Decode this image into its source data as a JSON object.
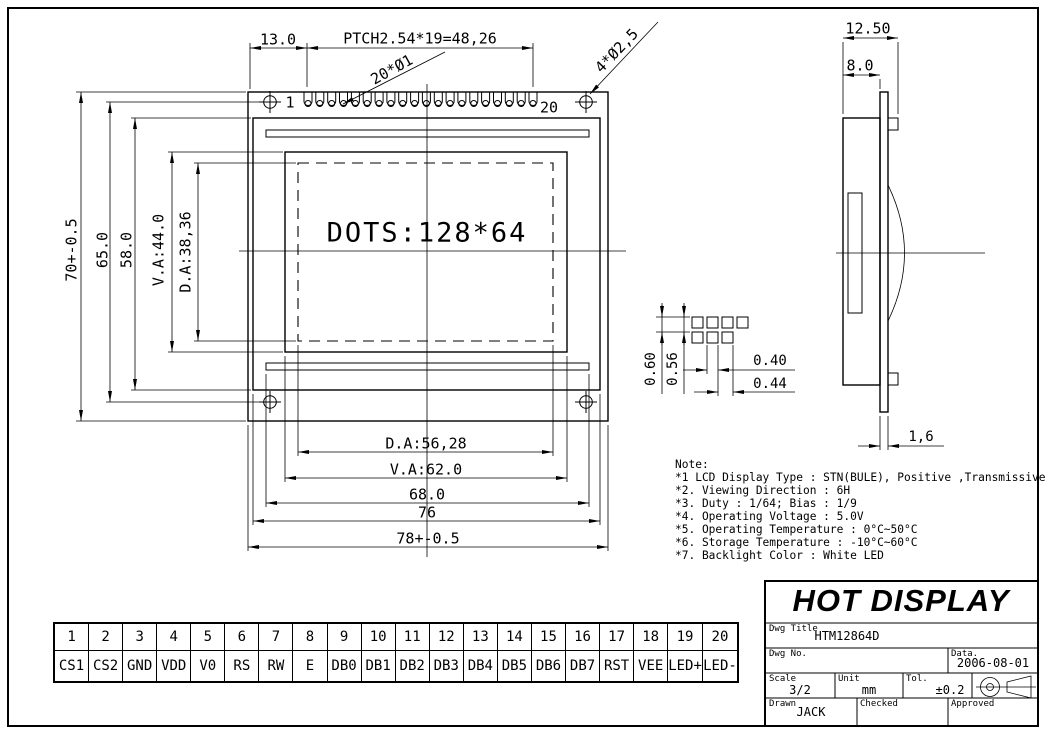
{
  "drawing": {
    "front": {
      "display_text": "DOTS:128*64",
      "pin_first_label": "1",
      "pin_last_label": "20",
      "dim_pin_offset": "13.0",
      "dim_pitch": "PTCH2.54*19=48,26",
      "callout_pin_holes": "20*Ø1",
      "callout_mount_holes": "4*Ø2,5",
      "dim_height_overall": "70+-0.5",
      "dim_height_holes": "65.0",
      "dim_height_frame": "58.0",
      "dim_height_va": "V.A:44.0",
      "dim_height_da": "D.A:38,36",
      "dim_width_da": "D.A:56,28",
      "dim_width_va": "V.A:62.0",
      "dim_width_slot": "68.0",
      "dim_width_frame": "76",
      "dim_width_overall": "78+-0.5"
    },
    "side": {
      "dim_total_depth": "12.50",
      "dim_body_depth": "8.0",
      "dim_pcb_thickness": "1,6"
    },
    "dot_detail": {
      "dim_dot_pitch_v": "0.60",
      "dim_dot_height": "0.56",
      "dim_dot_width": "0.40",
      "dim_dot_pitch_h": "0.44"
    }
  },
  "notes": {
    "lines": [
      "Note:",
      "*1 LCD Display Type : STN(BULE), Positive ,Transmissive",
      "*2. Viewing Direction : 6H",
      "*3. Duty : 1/64; Bias : 1/9",
      "*4. Operating Voltage : 5.0V",
      "*5. Operating Temperature : 0°C~50°C",
      "*6. Storage Temperature : -10°C~60°C",
      "*7. Backlight Color : White LED"
    ]
  },
  "pin_table": {
    "pins": [
      {
        "no": "1",
        "name": "CS1"
      },
      {
        "no": "2",
        "name": "CS2"
      },
      {
        "no": "3",
        "name": "GND"
      },
      {
        "no": "4",
        "name": "VDD"
      },
      {
        "no": "5",
        "name": "V0"
      },
      {
        "no": "6",
        "name": "RS"
      },
      {
        "no": "7",
        "name": "RW"
      },
      {
        "no": "8",
        "name": "E"
      },
      {
        "no": "9",
        "name": "DB0"
      },
      {
        "no": "10",
        "name": "DB1"
      },
      {
        "no": "11",
        "name": "DB2"
      },
      {
        "no": "12",
        "name": "DB3"
      },
      {
        "no": "13",
        "name": "DB4"
      },
      {
        "no": "14",
        "name": "DB5"
      },
      {
        "no": "15",
        "name": "DB6"
      },
      {
        "no": "16",
        "name": "DB7"
      },
      {
        "no": "17",
        "name": "RST"
      },
      {
        "no": "18",
        "name": "VEE"
      },
      {
        "no": "19",
        "name": "LED+"
      },
      {
        "no": "20",
        "name": "LED-"
      }
    ]
  },
  "title_block": {
    "company": "HOT DISPLAY",
    "dwg_title_label": "Dwg Title",
    "dwg_title": "HTM12864D",
    "dwg_no_label": "Dwg No.",
    "date_label": "Data.",
    "date": "2006-08-01",
    "scale_label": "Scale",
    "scale": "3/2",
    "unit_label": "Unit",
    "unit": "mm",
    "tol_label": "Tol.",
    "tol": "±0.2",
    "drawn_label": "Drawn",
    "drawn": "JACK",
    "checked_label": "Checked",
    "approved_label": "Approved"
  }
}
